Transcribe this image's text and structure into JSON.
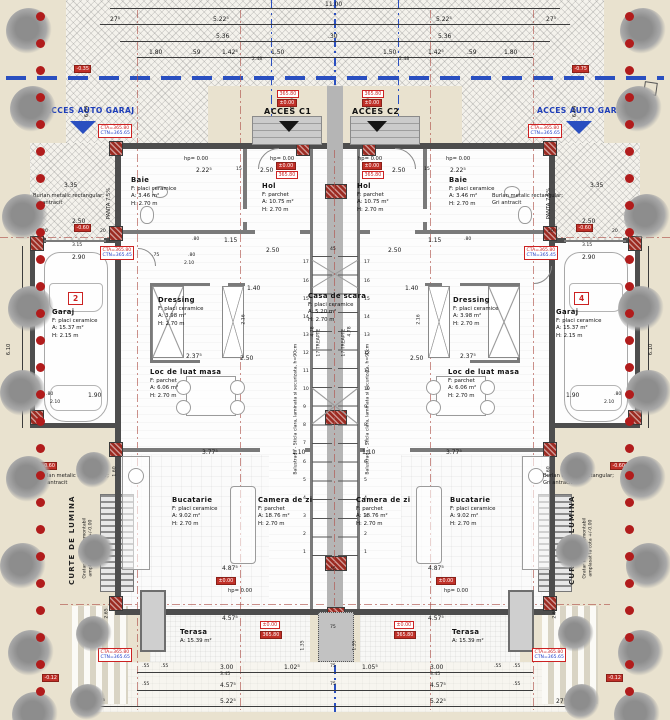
{
  "site": {
    "acces_auto_left": "ACCES AUTO GARAJ",
    "acces_auto_right": "ACCES AUTO GARAJ",
    "acces_c1": "ACCES C1",
    "acces_c2": "ACCES C2"
  },
  "rooms": [
    {
      "nm": "Baie",
      "f": "F: placi ceramice",
      "a": "A: 3.46 m²",
      "h": "H: 2.70 m",
      "x": 131,
      "y": 176
    },
    {
      "nm": "Hol",
      "f": "F: parchet",
      "a": "A: 10.75 m²",
      "h": "H: 2.70 m",
      "x": 262,
      "y": 182
    },
    {
      "nm": "Hol",
      "f": "F: parchet",
      "a": "A: 10.75 m²",
      "h": "H: 2.70 m",
      "x": 357,
      "y": 182
    },
    {
      "nm": "Baie",
      "f": "F: placi ceramice",
      "a": "A: 3.46 m²",
      "h": "H: 2.70 m",
      "x": 449,
      "y": 176
    },
    {
      "nm": "Dressing",
      "f": "F: placi ceramice",
      "a": "A: 3.98 m²",
      "h": "H: 2.70 m",
      "x": 158,
      "y": 296
    },
    {
      "nm": "Dressing",
      "f": "F: placi ceramice",
      "a": "A: 3.98 m²",
      "h": "H: 2.70 m",
      "x": 453,
      "y": 296
    },
    {
      "nm": "Garaj",
      "f": "F: placi ceramice",
      "a": "A: 15.37 m²",
      "h": "H: 2.15 m",
      "x": 52,
      "y": 308
    },
    {
      "nm": "Garaj",
      "f": "F: placi ceramice",
      "a": "A: 15.37 m²",
      "h": "H: 2.15 m",
      "x": 556,
      "y": 308
    },
    {
      "nm": "Loc de luat masa",
      "f": "F: parchet",
      "a": "A: 6.06 m²",
      "h": "H: 2.70 m",
      "x": 150,
      "y": 368
    },
    {
      "nm": "Loc de luat masa",
      "f": "F: parchet",
      "a": "A: 6.06 m²",
      "h": "H: 2.70 m",
      "x": 448,
      "y": 368
    },
    {
      "nm": "Casa de scara",
      "f": "F: placi ceramice",
      "a": "A: 5.20 m²",
      "h": "H: 2.70 m",
      "x": 308,
      "y": 292
    },
    {
      "nm": "Bucatarie",
      "f": "F: placi ceramice",
      "a": "A: 9.02 m²",
      "h": "H: 2.70 m",
      "x": 172,
      "y": 496
    },
    {
      "nm": "Camera de zi",
      "f": "F: parchet",
      "a": "A: 18.76 m²",
      "h": "H: 2.70 m",
      "x": 258,
      "y": 496
    },
    {
      "nm": "Camera de zi",
      "f": "F: parchet",
      "a": "A: 18.76 m²",
      "h": "H: 2.70 m",
      "x": 356,
      "y": 496
    },
    {
      "nm": "Bucatarie",
      "f": "F: placi ceramice",
      "a": "A: 9.02 m²",
      "h": "H: 2.70 m",
      "x": 450,
      "y": 496
    },
    {
      "nm": "Terasa",
      "a": "A: 15.39 m²",
      "x": 180,
      "y": 628
    },
    {
      "nm": "Terasa",
      "a": "A: 15.39 m²",
      "x": 452,
      "y": 628
    }
  ],
  "labels": [
    {
      "t": "11.00",
      "x": 325,
      "y": 2
    },
    {
      "t": "27⁵",
      "x": 110,
      "y": 17
    },
    {
      "t": "5.22⁵",
      "x": 213,
      "y": 17
    },
    {
      "t": "5.22⁵",
      "x": 436,
      "y": 17
    },
    {
      "t": "27⁵",
      "x": 546,
      "y": 17
    },
    {
      "t": "5.36",
      "x": 216,
      "y": 34
    },
    {
      "t": ".30",
      "x": 328,
      "y": 34
    },
    {
      "t": "5.36",
      "x": 438,
      "y": 34
    },
    {
      "t": "1.80",
      "x": 149,
      "y": 50
    },
    {
      "t": ".59",
      "x": 191,
      "y": 50
    },
    {
      "t": "1.42⁵",
      "x": 222,
      "y": 50
    },
    {
      "t": "1.50",
      "x": 271,
      "y": 50
    },
    {
      "t": "2.48",
      "x": 252,
      "y": 58,
      "c": "t"
    },
    {
      "t": "1.50",
      "x": 383,
      "y": 50
    },
    {
      "t": "1.42⁵",
      "x": 428,
      "y": 50
    },
    {
      "t": ".59",
      "x": 467,
      "y": 50
    },
    {
      "t": "1.80",
      "x": 504,
      "y": 50
    },
    {
      "t": "2.48",
      "x": 399,
      "y": 58,
      "c": "t"
    },
    {
      "t": "6.64",
      "x": 90,
      "y": 112,
      "r": 1,
      "c": "s"
    },
    {
      "t": "6.64",
      "x": 578,
      "y": 112,
      "r": 1,
      "c": "s"
    },
    {
      "t": "1.80",
      "x": 296,
      "y": 104,
      "r": 1,
      "c": "t"
    },
    {
      "t": "1.80",
      "x": 372,
      "y": 104,
      "r": 1,
      "c": "t"
    },
    {
      "t": "hp= 0.00",
      "x": 184,
      "y": 157,
      "c": "s"
    },
    {
      "t": "hp= 0.00",
      "x": 270,
      "y": 157,
      "c": "s"
    },
    {
      "t": "hp= 0.00",
      "x": 358,
      "y": 157,
      "c": "s"
    },
    {
      "t": "hp= 0.00",
      "x": 446,
      "y": 157,
      "c": "s"
    },
    {
      "t": "2.22⁵",
      "x": 196,
      "y": 168
    },
    {
      "t": "15",
      "x": 236,
      "y": 168,
      "c": "t"
    },
    {
      "t": "2.50",
      "x": 260,
      "y": 168
    },
    {
      "t": "2.50",
      "x": 392,
      "y": 168
    },
    {
      "t": "15",
      "x": 424,
      "y": 168,
      "c": "t"
    },
    {
      "t": "2.22⁵",
      "x": 450,
      "y": 168
    },
    {
      "t": "PANTA 7,5%",
      "x": 112,
      "y": 214,
      "r": 1,
      "c": "s"
    },
    {
      "t": "PANTA 7,5%",
      "x": 552,
      "y": 214,
      "r": 1,
      "c": "s"
    },
    {
      "t": "3.35",
      "x": 64,
      "y": 183
    },
    {
      "t": "3.35",
      "x": 590,
      "y": 183
    },
    {
      "t": "2.50",
      "x": 72,
      "y": 219
    },
    {
      "t": "20",
      "x": 42,
      "y": 230,
      "c": "t"
    },
    {
      "t": "20",
      "x": 100,
      "y": 230,
      "c": "t"
    },
    {
      "t": "3.15",
      "x": 72,
      "y": 244,
      "c": "t"
    },
    {
      "t": "2.90",
      "x": 72,
      "y": 255
    },
    {
      "t": "2.50",
      "x": 582,
      "y": 219
    },
    {
      "t": "20",
      "x": 548,
      "y": 230,
      "c": "t"
    },
    {
      "t": "20",
      "x": 612,
      "y": 230,
      "c": "t"
    },
    {
      "t": "3.15",
      "x": 582,
      "y": 244,
      "c": "t"
    },
    {
      "t": "2.90",
      "x": 582,
      "y": 255
    },
    {
      "t": ".80",
      "x": 192,
      "y": 238,
      "c": "t"
    },
    {
      "t": "1.15",
      "x": 224,
      "y": 238
    },
    {
      "t": "1.15",
      "x": 428,
      "y": 238
    },
    {
      "t": ".80",
      "x": 464,
      "y": 238,
      "c": "t"
    },
    {
      "t": ".75",
      "x": 152,
      "y": 254,
      "c": "t"
    },
    {
      "t": ".80",
      "x": 188,
      "y": 254,
      "c": "t"
    },
    {
      "t": "2.10",
      "x": 184,
      "y": 262,
      "c": "t"
    },
    {
      "t": "6.10",
      "x": 12,
      "y": 350,
      "r": 1,
      "c": "s"
    },
    {
      "t": "6.10",
      "x": 654,
      "y": 350,
      "r": 1,
      "c": "s"
    },
    {
      "t": "2.50",
      "x": 266,
      "y": 248
    },
    {
      "t": "45",
      "x": 330,
      "y": 248,
      "c": "t"
    },
    {
      "t": "2.50",
      "x": 388,
      "y": 248
    },
    {
      "t": "1.40",
      "x": 247,
      "y": 286
    },
    {
      "t": "1.40",
      "x": 405,
      "y": 286
    },
    {
      "t": "2.16",
      "x": 247,
      "y": 320,
      "r": 1,
      "c": "t"
    },
    {
      "t": "2.16",
      "x": 422,
      "y": 320,
      "r": 1,
      "c": "t"
    },
    {
      "t": "4.78",
      "x": 316,
      "y": 332,
      "r": 1,
      "c": "t"
    },
    {
      "t": "4.78",
      "x": 353,
      "y": 332,
      "r": 1,
      "c": "t"
    },
    {
      "t": "2.50",
      "x": 240,
      "y": 356
    },
    {
      "t": "2.50",
      "x": 410,
      "y": 356
    },
    {
      "t": "2.37⁵",
      "x": 186,
      "y": 354
    },
    {
      "t": "2.37⁵",
      "x": 460,
      "y": 354
    },
    {
      "t": ".80",
      "x": 46,
      "y": 393,
      "c": "t"
    },
    {
      "t": "1.90",
      "x": 88,
      "y": 393
    },
    {
      "t": "2.10",
      "x": 50,
      "y": 401,
      "c": "t"
    },
    {
      "t": "1.90",
      "x": 566,
      "y": 393
    },
    {
      "t": ".80",
      "x": 614,
      "y": 393,
      "c": "t"
    },
    {
      "t": "2.10",
      "x": 604,
      "y": 401,
      "c": "t"
    },
    {
      "t": "1.60",
      "x": 118,
      "y": 472,
      "r": 1,
      "c": "t"
    },
    {
      "t": "1.60",
      "x": 552,
      "y": 472,
      "r": 1,
      "c": "t"
    },
    {
      "t": "2.65",
      "x": 110,
      "y": 614,
      "r": 1,
      "c": "t"
    },
    {
      "t": "2.65",
      "x": 558,
      "y": 614,
      "r": 1,
      "c": "t"
    },
    {
      "t": "3.77⁵",
      "x": 202,
      "y": 450
    },
    {
      "t": "1.10",
      "x": 292,
      "y": 450
    },
    {
      "t": "1.10",
      "x": 362,
      "y": 450
    },
    {
      "t": "3.77⁵",
      "x": 446,
      "y": 450
    },
    {
      "t": "4.87⁵",
      "x": 222,
      "y": 566
    },
    {
      "t": "4.87⁵",
      "x": 428,
      "y": 566
    },
    {
      "t": "hp= 0.00",
      "x": 228,
      "y": 589,
      "c": "s"
    },
    {
      "t": "hp= 0.00",
      "x": 444,
      "y": 589,
      "c": "s"
    },
    {
      "t": "45",
      "x": 330,
      "y": 568,
      "c": "t"
    },
    {
      "t": "75",
      "x": 330,
      "y": 626,
      "c": "t"
    },
    {
      "t": "1.35",
      "x": 306,
      "y": 646,
      "r": 1,
      "c": "t"
    },
    {
      "t": "1.35",
      "x": 358,
      "y": 646,
      "r": 1,
      "c": "t"
    },
    {
      "t": "4.57⁵",
      "x": 222,
      "y": 616
    },
    {
      "t": "4.57⁵",
      "x": 428,
      "y": 616
    },
    {
      "t": ".55",
      "x": 142,
      "y": 665,
      "c": "t"
    },
    {
      "t": ".55",
      "x": 161,
      "y": 665,
      "c": "t"
    },
    {
      "t": "3.00",
      "x": 220,
      "y": 665
    },
    {
      "t": "3.45",
      "x": 220,
      "y": 673,
      "c": "t"
    },
    {
      "t": "1.02⁵",
      "x": 284,
      "y": 665
    },
    {
      "t": "75",
      "x": 330,
      "y": 665,
      "c": "t"
    },
    {
      "t": "1.05⁵",
      "x": 362,
      "y": 665
    },
    {
      "t": "3.00",
      "x": 430,
      "y": 665
    },
    {
      "t": "3.45",
      "x": 430,
      "y": 673,
      "c": "t"
    },
    {
      "t": ".55",
      "x": 494,
      "y": 665,
      "c": "t"
    },
    {
      "t": ".55",
      "x": 513,
      "y": 665,
      "c": "t"
    },
    {
      "t": ".55",
      "x": 142,
      "y": 683,
      "c": "t"
    },
    {
      "t": "4.57⁵",
      "x": 220,
      "y": 683
    },
    {
      "t": "75",
      "x": 330,
      "y": 683,
      "c": "t"
    },
    {
      "t": "4.57⁵",
      "x": 430,
      "y": 683
    },
    {
      "t": ".55",
      "x": 513,
      "y": 683,
      "c": "t"
    },
    {
      "t": "27⁵",
      "x": 95,
      "y": 699
    },
    {
      "t": "5.22⁵",
      "x": 220,
      "y": 699
    },
    {
      "t": "5.22⁵",
      "x": 430,
      "y": 699
    },
    {
      "t": "27⁵",
      "x": 556,
      "y": 699
    },
    {
      "t": "Burlan metalic rectangular;",
      "x": 33,
      "y": 194,
      "c": "s"
    },
    {
      "t": "Gri antracit",
      "x": 33,
      "y": 201,
      "c": "s"
    },
    {
      "t": "Burlan metalic rectangular;",
      "x": 492,
      "y": 194,
      "c": "s"
    },
    {
      "t": "Gri antracit",
      "x": 492,
      "y": 201,
      "c": "s"
    },
    {
      "t": "Burlan metalic rectangular;",
      "x": 38,
      "y": 474,
      "c": "s"
    },
    {
      "t": "Gri antracit",
      "x": 38,
      "y": 481,
      "c": "s"
    },
    {
      "t": "Burlan metalic rectangular;",
      "x": 543,
      "y": 474,
      "c": "s"
    },
    {
      "t": "Gri antracit",
      "x": 543,
      "y": 481,
      "c": "s"
    },
    {
      "t": "CURTE DE LUMINA",
      "x": 76,
      "y": 578,
      "r": 1,
      "c": "cb"
    },
    {
      "t": "Gratar metalic demontabil",
      "x": 88,
      "y": 574,
      "r": 1,
      "c": "t"
    },
    {
      "t": "amplasat la cota +/-0.00",
      "x": 94,
      "y": 572,
      "r": 1,
      "c": "t"
    },
    {
      "t": "CURTE DE LUMINA",
      "x": 576,
      "y": 578,
      "r": 1,
      "c": "cb"
    },
    {
      "t": "Gratar metalic demontabil",
      "x": 588,
      "y": 574,
      "r": 1,
      "c": "t"
    },
    {
      "t": "amplasat la cota +/-0.00",
      "x": 594,
      "y": 572,
      "r": 1,
      "c": "t"
    },
    {
      "t": "Balustrada - Sticla clara, laminata si securizata, h=90cm",
      "x": 299,
      "y": 470,
      "r": 1,
      "c": "t"
    },
    {
      "t": "Balustrada - Sticla clara, laminata si securizata, h=90cm",
      "x": 371,
      "y": 470,
      "r": 1,
      "c": "t"
    },
    {
      "t": "17 TREAPTE",
      "x": 322,
      "y": 352,
      "r": 1,
      "c": "t"
    },
    {
      "t": "17 TREAPTE",
      "x": 347,
      "y": 352,
      "r": 1,
      "c": "t"
    }
  ],
  "red_boxes": [
    {
      "t": "365.80",
      "x": 277,
      "y": 90
    },
    {
      "t": "±0.00",
      "x": 277,
      "y": 99,
      "fill": 1
    },
    {
      "t": "365.80",
      "x": 362,
      "y": 90
    },
    {
      "t": "±0.00",
      "x": 362,
      "y": 99,
      "fill": 1
    },
    {
      "t": "±0.00",
      "x": 276,
      "y": 162,
      "fill": 1
    },
    {
      "t": "365.80",
      "x": 276,
      "y": 171
    },
    {
      "t": "±0.00",
      "x": 362,
      "y": 162,
      "fill": 1
    },
    {
      "t": "365.80",
      "x": 362,
      "y": 171
    },
    {
      "t": "-0.35",
      "x": 74,
      "y": 65,
      "fill": 1
    },
    {
      "t": "-0.75",
      "x": 572,
      "y": 65,
      "fill": 1
    },
    {
      "t": "-0.60",
      "x": 74,
      "y": 224,
      "fill": 1
    },
    {
      "t": "-0.60",
      "x": 576,
      "y": 224,
      "fill": 1
    },
    {
      "t": "-0.60",
      "x": 40,
      "y": 462,
      "fill": 1
    },
    {
      "t": "-0.60",
      "x": 610,
      "y": 462,
      "fill": 1
    },
    {
      "t": "±0.00",
      "x": 216,
      "y": 577,
      "fill": 1
    },
    {
      "t": "±0.00",
      "x": 436,
      "y": 577,
      "fill": 1
    },
    {
      "t": "±0.00",
      "x": 260,
      "y": 621
    },
    {
      "t": "365.80",
      "x": 260,
      "y": 631,
      "fill": 1
    },
    {
      "t": "±0.00",
      "x": 394,
      "y": 621
    },
    {
      "t": "365.80",
      "x": 394,
      "y": 631,
      "fill": 1
    },
    {
      "t": "-0.12",
      "x": 42,
      "y": 674,
      "fill": 1
    },
    {
      "t": "-0.12",
      "x": 606,
      "y": 674,
      "fill": 1
    }
  ],
  "cta_boxes": [
    {
      "a": "CTA=365.80",
      "n": "CTN=365.65",
      "x": 98,
      "y": 124
    },
    {
      "a": "CTA=365.80",
      "n": "CTN=365.65",
      "x": 528,
      "y": 124
    },
    {
      "a": "CTA=365.80",
      "n": "CTN=365.45",
      "x": 100,
      "y": 246
    },
    {
      "a": "CTA=365.80",
      "n": "CTN=365.45",
      "x": 524,
      "y": 246
    },
    {
      "a": "CTA=365.80",
      "n": "CTN=365.65",
      "x": 98,
      "y": 648
    },
    {
      "a": "CTA=365.80",
      "n": "CTN=365.65",
      "x": 532,
      "y": 648
    }
  ],
  "unit_boxes": [
    {
      "t": "2",
      "x": 68,
      "y": 292
    },
    {
      "t": "4",
      "x": 574,
      "y": 292
    }
  ],
  "stairs": {
    "steps": [
      "1",
      "2",
      "3",
      "4",
      "5",
      "6",
      "7",
      "8",
      "9",
      "10",
      "11",
      "12",
      "13",
      "14",
      "15",
      "16",
      "17"
    ]
  },
  "colors": {
    "accent_red": "#c03028",
    "accent_blue": "#2a4fc0",
    "bollard": "#b11c1c"
  }
}
